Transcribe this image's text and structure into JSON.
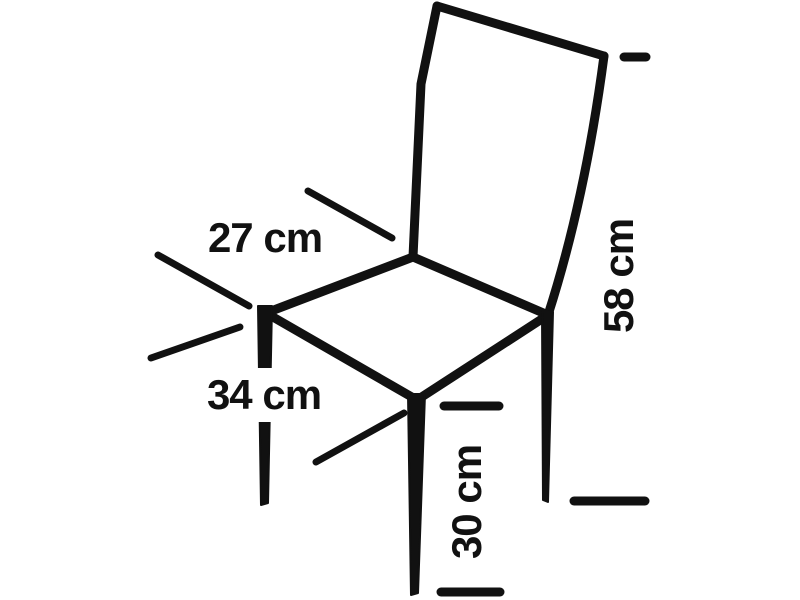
{
  "diagram": {
    "subject": "Line drawing of a chair annotated with measurements",
    "background_color": "#ffffff",
    "line_color": "#111111",
    "dimensions": [
      {
        "id": "seat-back-edge",
        "label": "27 cm",
        "value": 27,
        "unit": "cm",
        "orientation": "horizontal",
        "points_to": "seat edge between left and back corners"
      },
      {
        "id": "seat-front-edge",
        "label": "34 cm",
        "value": 34,
        "unit": "cm",
        "orientation": "horizontal",
        "points_to": "seat edge between left and front corners"
      },
      {
        "id": "backrest-height",
        "label": "58 cm",
        "value": 58,
        "unit": "cm",
        "orientation": "vertical",
        "points_to": "top of backrest down to bottom of rear leg"
      },
      {
        "id": "seat-height",
        "label": "30 cm",
        "value": 30,
        "unit": "cm",
        "orientation": "vertical",
        "points_to": "seat level down to bottom of front leg"
      }
    ]
  }
}
